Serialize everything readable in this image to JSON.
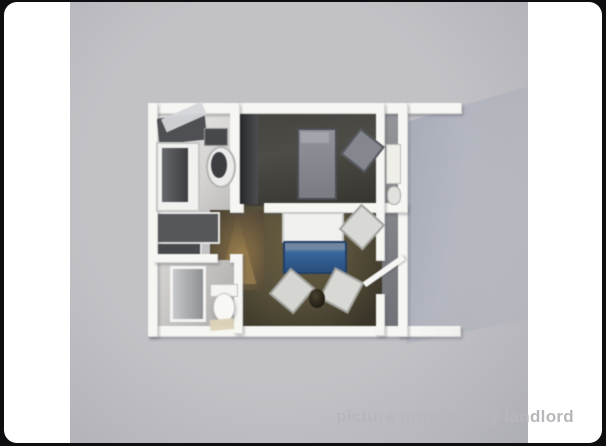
{
  "page": {
    "background_color": "#0e0e10"
  },
  "card": {
    "background_color": "#ffffff"
  },
  "photo": {
    "background_color": "#c1c1c6",
    "description": "3D rendered top-down floor plan of a one-bedroom apartment"
  },
  "watermark": {
    "text": "picture provided by landlord",
    "color": "#b6b6bb"
  },
  "floorplan": {
    "rooms": [
      "kitchen",
      "bedroom",
      "bathroom",
      "living-room",
      "hallway",
      "side-bathroom"
    ],
    "elements": [
      {
        "n": "cast-shadow",
        "x": 336,
        "y": 84,
        "w": 124,
        "h": 258,
        "bg": "linear-gradient(100deg, rgba(145,153,170,.55) 0%, rgba(160,167,182,.35) 45%, rgba(178,183,196,.12) 100%)",
        "clip": "polygon(0% 14%, 100% 0%, 100% 90%, 0% 100%)",
        "blur": 2.5
      },
      {
        "n": "kitchen-floor",
        "x": 84,
        "y": 108,
        "w": 78,
        "h": 100,
        "bg": "linear-gradient(135deg,#edebe9 0%,#d2d1cf 70%,#bdbcba 100%)"
      },
      {
        "n": "bedroom-floor",
        "x": 166,
        "y": 108,
        "w": 146,
        "h": 100,
        "bg": "linear-gradient(170deg,#45433d 0%,#4e4c46 40%,#34332e 100%)"
      },
      {
        "n": "side-strip-floor",
        "x": 306,
        "y": 108,
        "w": 26,
        "h": 222,
        "bg": "linear-gradient(180deg,#94969a,#6e7175)"
      },
      {
        "n": "living-room-floor",
        "x": 166,
        "y": 204,
        "w": 146,
        "h": 126,
        "bg": "radial-gradient(ellipse at 42% 30%,#6a5e41 0%,#57503a 45%,#3a3529 85%)"
      },
      {
        "n": "hallway-floor",
        "x": 140,
        "y": 208,
        "w": 54,
        "h": 80,
        "bg": "radial-gradient(at 60% 55%,#8a7146,#564b38 75%,#3c362b)"
      },
      {
        "n": "hallway-light-cone",
        "x": 146,
        "y": 212,
        "w": 44,
        "h": 70,
        "clip": "polygon(48% 0%, 8% 100%, 92% 100%)",
        "bg": "linear-gradient(180deg,rgba(190,160,100,0),rgba(186,152,92,.5))"
      },
      {
        "n": "kitchen-cabinet-block",
        "x": 80,
        "y": 210,
        "w": 66,
        "h": 28,
        "bg": "#55575b",
        "bd": "2px solid #e8e8e5"
      },
      {
        "n": "closet-block",
        "x": 80,
        "y": 240,
        "w": 48,
        "h": 24,
        "bg": "#47494d",
        "bd": "2px solid #dddddb"
      },
      {
        "n": "bathroom-floor",
        "x": 84,
        "y": 258,
        "w": 84,
        "h": 70,
        "bg": "linear-gradient(120deg,#d8d7d5,#aaa9a7)"
      },
      {
        "n": "wall-top",
        "cls": "wall",
        "x": 78,
        "y": 101,
        "w": 314,
        "h": 11
      },
      {
        "n": "wall-bottom",
        "cls": "wall",
        "x": 78,
        "y": 324,
        "w": 313,
        "h": 11
      },
      {
        "n": "wall-left",
        "cls": "wall",
        "x": 78,
        "y": 101,
        "w": 10,
        "h": 234
      },
      {
        "n": "wall-right",
        "cls": "wall",
        "x": 328,
        "y": 101,
        "w": 10,
        "h": 234
      },
      {
        "n": "wall-kitchen-divider",
        "cls": "wall",
        "x": 160,
        "y": 101,
        "w": 10,
        "h": 108
      },
      {
        "n": "wall-middle-stub",
        "cls": "wall",
        "x": 160,
        "y": 201,
        "w": 14,
        "h": 10
      },
      {
        "n": "wall-middle",
        "cls": "wall",
        "x": 194,
        "y": 201,
        "w": 144,
        "h": 10
      },
      {
        "n": "wall-side-divider-top",
        "cls": "wall",
        "x": 306,
        "y": 101,
        "w": 9,
        "h": 158
      },
      {
        "n": "wall-side-divider-bottom",
        "cls": "wall",
        "x": 306,
        "y": 292,
        "w": 9,
        "h": 42
      },
      {
        "n": "wall-bathroom-top-left",
        "cls": "wall",
        "x": 84,
        "y": 252,
        "w": 64,
        "h": 9
      },
      {
        "n": "wall-bathroom-top-right",
        "cls": "wall",
        "x": 160,
        "y": 252,
        "w": 12,
        "h": 9
      },
      {
        "n": "wall-bathroom-right",
        "cls": "wall",
        "x": 164,
        "y": 252,
        "w": 9,
        "h": 80
      },
      {
        "n": "kitchen-counter-top",
        "x": 88,
        "y": 114,
        "w": 48,
        "h": 26,
        "bg": "#4e5054",
        "rot": -6,
        "br": "2px"
      },
      {
        "n": "kitchen-open-lid",
        "x": 92,
        "y": 108,
        "w": 44,
        "h": 14,
        "bg": "#d4d6da",
        "rot": -24,
        "op": 0.95
      },
      {
        "n": "kitchen-unit",
        "x": 86,
        "y": 140,
        "w": 40,
        "h": 66,
        "bg": "#f1f1ef",
        "bd": "2px solid #c6c6c4"
      },
      {
        "n": "kitchen-unit-front",
        "x": 92,
        "y": 146,
        "w": 26,
        "h": 54,
        "bg": "linear-gradient(90deg,#65676b,#3c3e42)"
      },
      {
        "n": "kitchen-sink-rim",
        "x": 136,
        "y": 144,
        "w": 26,
        "h": 38,
        "br": "50%",
        "bg": "#ebebe9",
        "bd": "2px solid #b4b4b2"
      },
      {
        "n": "kitchen-sink-basin",
        "x": 141,
        "y": 150,
        "w": 16,
        "h": 26,
        "br": "50%",
        "bg": "#3c3e42"
      },
      {
        "n": "kitchen-appliance-box",
        "x": 134,
        "y": 126,
        "w": 22,
        "h": 16,
        "bg": "#46484c",
        "bd": "1px solid #9a9a98"
      },
      {
        "n": "bedroom-wardrobe",
        "x": 170,
        "y": 112,
        "w": 18,
        "h": 90,
        "bg": "linear-gradient(90deg,#26282c,#4c4e52)"
      },
      {
        "n": "bedroom-bed",
        "x": 227,
        "y": 126,
        "w": 36,
        "h": 68,
        "bg": "linear-gradient(180deg,#90949a,#797d83)",
        "bd": "2px solid #4b4e53"
      },
      {
        "n": "bedroom-bed-pillow",
        "x": 231,
        "y": 130,
        "w": 28,
        "h": 11,
        "bg": "#a2a6ac"
      },
      {
        "n": "bedroom-chair",
        "x": 277,
        "y": 132,
        "w": 27,
        "h": 29,
        "rot": 38,
        "bg": "#84888e",
        "bd": "2px solid #54575c"
      },
      {
        "n": "side-bath-vanity",
        "x": 316,
        "y": 142,
        "w": 13,
        "h": 38,
        "bg": "#efeee8",
        "bd": "1px solid #bcbcb6"
      },
      {
        "n": "side-bath-toilet",
        "x": 317,
        "y": 184,
        "w": 12,
        "h": 17,
        "br": "45%",
        "bg": "#e1e1dd",
        "bd": "1px solid #a8a8a4"
      },
      {
        "n": "living-table",
        "x": 212,
        "y": 210,
        "w": 58,
        "h": 27,
        "bg": "#f0f0ee",
        "bd": "2px solid #c9c9c7"
      },
      {
        "n": "living-sofa-bed",
        "x": 213,
        "y": 239,
        "w": 60,
        "h": 29,
        "br": "2px",
        "bg": "linear-gradient(180deg,#7288a2 0%,#7288a2 20%,#38679b 32%,#294e7d 100%)",
        "bd": "2px solid #223f66"
      },
      {
        "n": "living-chair-right",
        "x": 276,
        "y": 208,
        "w": 28,
        "h": 30,
        "rot": 42,
        "bg": "#d8d8d4",
        "bd": "2px solid #a2a29e"
      },
      {
        "n": "living-chair-left",
        "x": 206,
        "y": 272,
        "w": 28,
        "h": 30,
        "rot": 40,
        "bg": "#d5d5d1",
        "bd": "2px solid #a0a09c"
      },
      {
        "n": "living-chair-bottom",
        "x": 255,
        "y": 271,
        "w": 29,
        "h": 31,
        "rot": 28,
        "bg": "#d8d8d4",
        "bd": "2px solid #a2a29e"
      },
      {
        "n": "living-plant",
        "x": 239,
        "y": 287,
        "w": 16,
        "h": 19,
        "br": "50%",
        "bg": "radial-gradient(at 40% 35%,#4a4230,#1e1a12 75%)"
      },
      {
        "n": "bathroom-shower",
        "x": 100,
        "y": 264,
        "w": 30,
        "h": 50,
        "bg": "linear-gradient(90deg,#c6c8ca,#8e9092)",
        "bd": "3px solid #f3f3f1"
      },
      {
        "n": "bathroom-toilet-tank",
        "x": 140,
        "y": 282,
        "w": 26,
        "h": 11,
        "bg": "#f4f4f2",
        "bd": "1px solid #c2c2c0"
      },
      {
        "n": "bathroom-toilet-bowl",
        "x": 143,
        "y": 291,
        "w": 20,
        "h": 27,
        "br": "50%",
        "bg": "#f8f8f6",
        "bd": "1px solid #c6c6c4",
        "sh": "1px 2px 3px rgba(60,60,70,.35)"
      },
      {
        "n": "bathroom-mat",
        "x": 140,
        "y": 317,
        "w": 24,
        "h": 11,
        "bg": "#ddd3b8",
        "rot": -5,
        "op": 0.95
      },
      {
        "n": "open-door",
        "x": 290,
        "y": 266,
        "w": 48,
        "h": 6,
        "bg": "#f6f6f4",
        "rot": -35,
        "br": "1px",
        "sh": "1px 1px 2px rgba(60,60,70,.4)"
      }
    ]
  }
}
